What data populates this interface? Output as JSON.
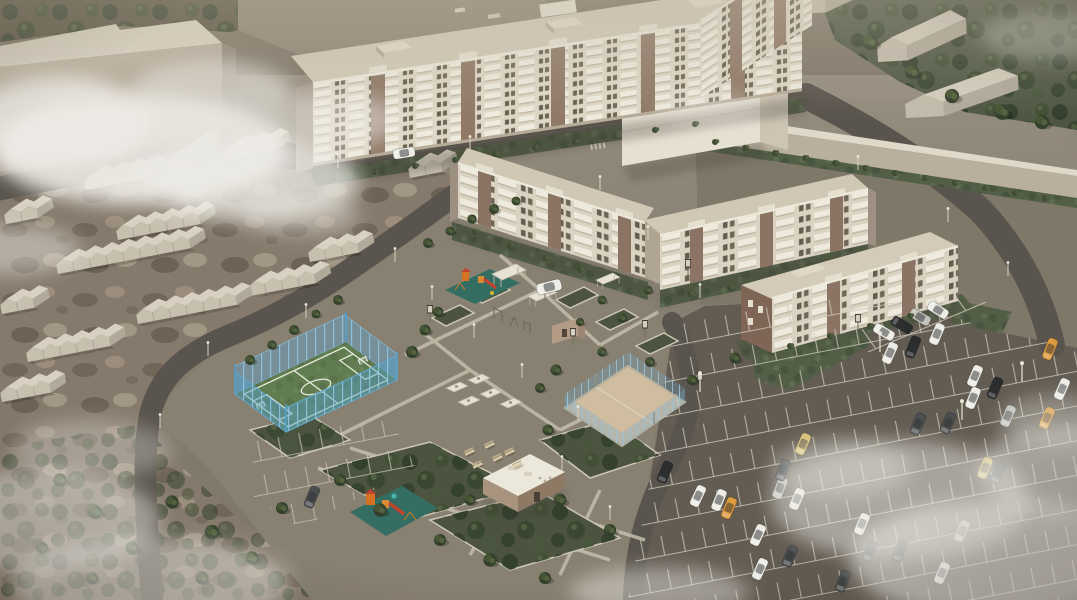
{
  "meta": {
    "title": "Aerial 3D architectural render of a residential district",
    "view": "bird's-eye perspective",
    "style": "sepia, desaturated model with white clouds and fog over the corners"
  },
  "palette": {
    "asphalt": "#5f5850",
    "pavement": "#867e70",
    "dirt": "#84786b",
    "path": "#cfc8b8",
    "turf": "#5c7a4d",
    "turf_lines": "#e9efe1",
    "fence_blue": "#58a8d8",
    "sand": "#d2bda1",
    "lawn": "#4d5a43",
    "tree": "#2c3a28",
    "facade_beige": "#e2dac9",
    "facade_brown": "#8a7161",
    "roof_tan": "#d2c9b7",
    "garage_roof": "#f0eadd",
    "cloud": "#f2f0ec",
    "playground_mat": "#2e6a60",
    "playground_equipment": "#d96f1f",
    "car_white": "#f1f0ec",
    "car_black": "#23252a",
    "car_orange": "#e09a3c"
  },
  "scene": {
    "buildings": {
      "long_apartment_slab": "8-9 storey beige apartment block with white balconies and brown accent bays",
      "apartment_wing": "perpendicular apartment wing running off the top edge",
      "big_corner_block": "large plain beige building, top-left, half hidden by cloud",
      "tall_plain_block": "tall featureless light building behind the mid-rise courtyard",
      "midrise_l_building_west": "4-5 storey L-shaped apartment building with balconies",
      "midrise_building_east": "4-5 storey apartment building with balconies",
      "detached_midrise_south": "4 storey apartment building with brown gable ends",
      "boundary_wall": "long light wall along the north-east edge",
      "warehouses": "three light sheds behind the wall among dense trees",
      "garage_rows": "about fifty small single-storey gabled garages on unpaved ground, west side",
      "utility_building": "flat-roofed single-storey service building in the south courtyard",
      "kiosk": "tiny kiosk beside the central walkways"
    },
    "recreation": {
      "football_pitch": {
        "surface": "green turf with white markings",
        "fence": "translucent blue mesh on posts",
        "goals": 2
      },
      "volleyball_court": {
        "surface": "sand",
        "fence": "low blue mesh on grey posts"
      },
      "playgrounds": {
        "count": 2,
        "equipment": "orange towers and slides on dark-teal safety mats"
      },
      "pergolas": 3,
      "picnic_benches": 6,
      "game_tables": 5,
      "info_boards": 7,
      "outdoor_gym": "small metal exercise frames"
    },
    "parking": {
      "main_lot": "large asphalt lot with white herring-bone stalls, south-east quadrant",
      "cars_visible": 38,
      "car_colors": [
        "white",
        "silver",
        "black",
        "dark-grey",
        "orange",
        "beige"
      ],
      "small_lot": "half-empty marked stalls south-west of the courtyard"
    },
    "landscape": {
      "groves": [
        "dense dark trees along the top-right edge",
        "scrub and mud in the bottom-left"
      ],
      "planters": "white-curbed planting beds with shrubs across the courtyard",
      "lawns": "lawn strips along every facade and road",
      "clouds": "white clouds over the top-left block, fog in bottom corners"
    },
    "roads": "dark asphalt loop road with curved junctions linking all areas"
  }
}
